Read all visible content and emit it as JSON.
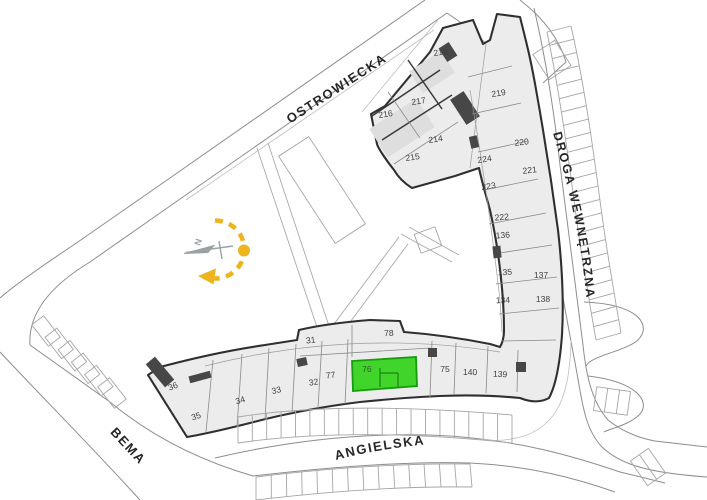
{
  "plan": {
    "highlighted_unit": "76",
    "streets": {
      "ostrowiecka": "OSTROWIECKA",
      "droga_wewnetrzna": "DROGA WEWNĘTRZNA",
      "angielska": "ANGIELSKA",
      "bema": "BEMA"
    },
    "compass": {
      "north": "N"
    },
    "units": [
      "218",
      "219",
      "217",
      "216",
      "214",
      "215",
      "220",
      "224",
      "221",
      "223",
      "222",
      "136",
      "135",
      "137",
      "134",
      "138",
      "139",
      "140",
      "75",
      "76",
      "78",
      "31",
      "77",
      "32",
      "33",
      "34",
      "35",
      "36"
    ],
    "colors": {
      "highlight_fill": "#41d52c",
      "highlight_stroke": "#159e0c",
      "highlight_wall": "#1f8f15",
      "sun_path": "#edb41c",
      "north_arrow": "#9aa3a3",
      "wall": "#2f2f2f",
      "unit_fill": "#ececec"
    }
  }
}
